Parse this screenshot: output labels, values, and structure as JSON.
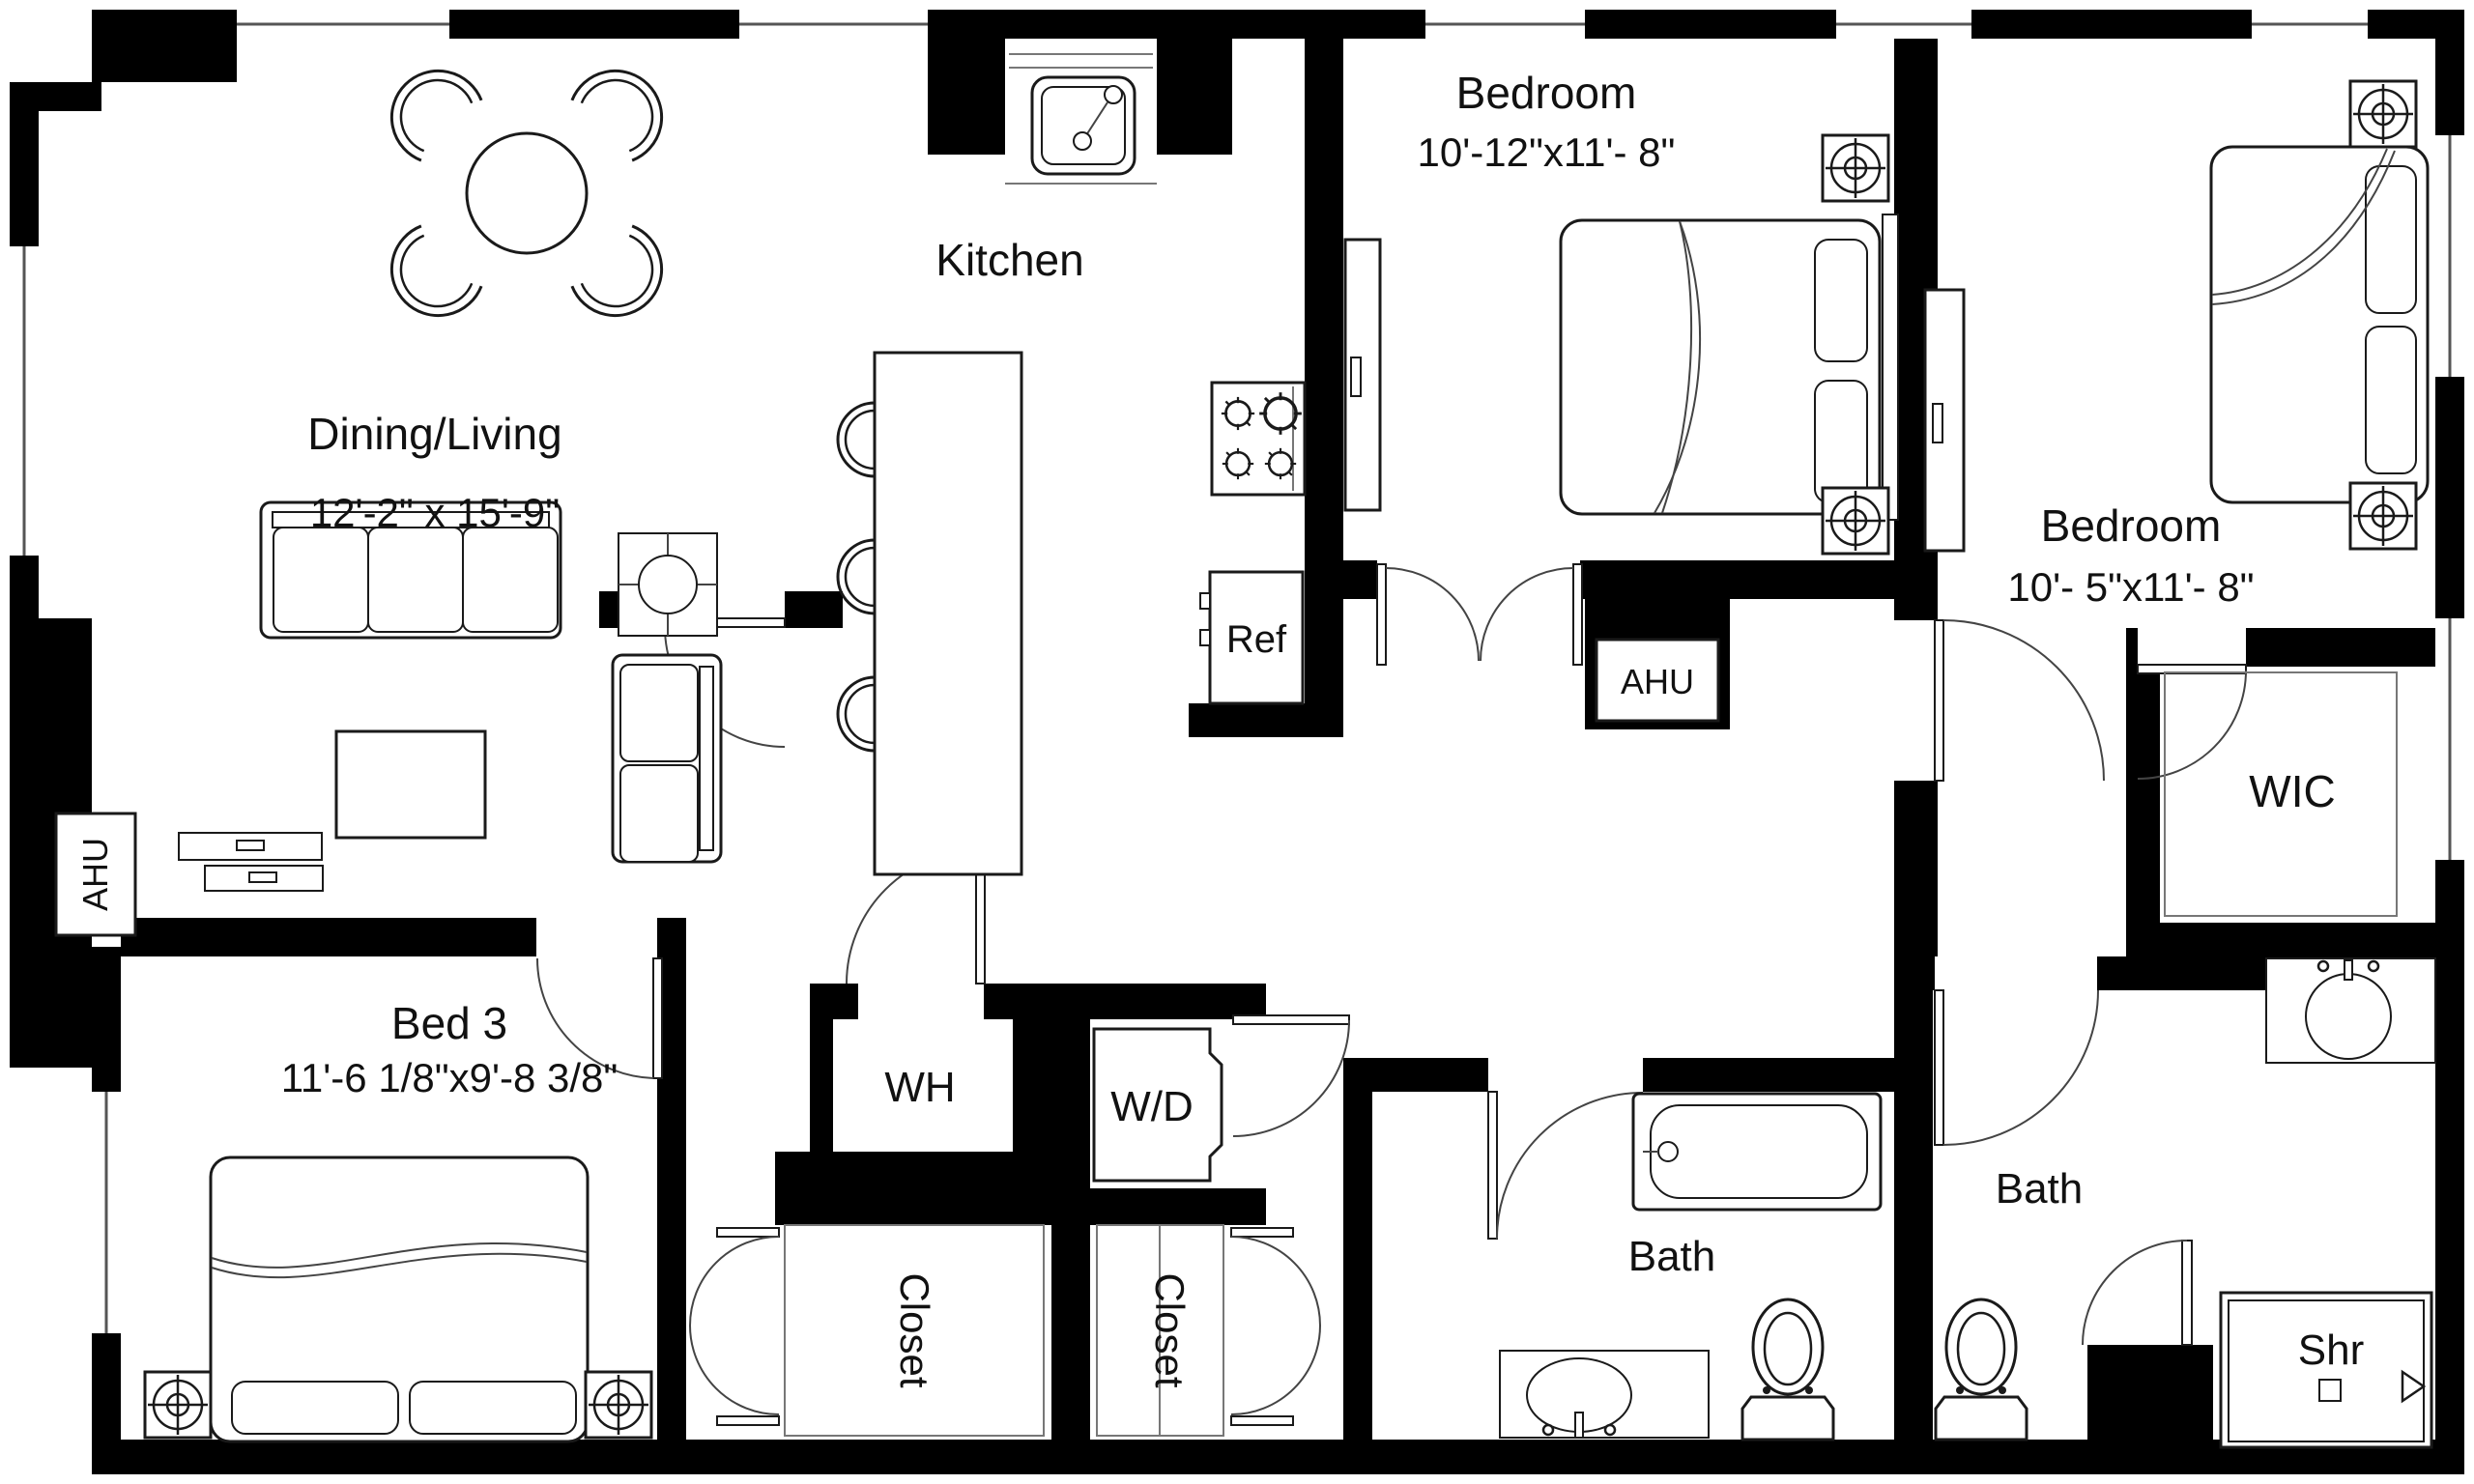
{
  "floorplan": {
    "rooms": {
      "dining_living": {
        "label": "Dining/Living",
        "dimensions": "12'-2\" x 15'-9\""
      },
      "kitchen": {
        "label": "Kitchen"
      },
      "bedroom_top": {
        "label": "Bedroom",
        "dimensions": "10'-12\"x11'- 8\""
      },
      "bedroom_right": {
        "label": "Bedroom",
        "dimensions": "10'- 5\"x11'- 8\""
      },
      "bed3": {
        "label": "Bed 3",
        "dimensions": "11'-6 1/8\"x9'-8 3/8\""
      },
      "wic": {
        "label": "WIC"
      },
      "bath_left": {
        "label": "Bath"
      },
      "bath_right": {
        "label": "Bath"
      },
      "closet_left": {
        "label": "Closet"
      },
      "closet_right": {
        "label": "Closet"
      },
      "shower": {
        "label": "Shr"
      },
      "water_heater": {
        "label": "WH"
      },
      "washer_dryer": {
        "label": "W/D"
      },
      "refrigerator": {
        "label": "Ref"
      },
      "ahu_left": {
        "label": "AHU"
      },
      "ahu_hall": {
        "label": "AHU"
      }
    },
    "colors": {
      "walls": "#000000",
      "background": "#ffffff",
      "furniture_stroke": "#1a1a1a"
    }
  }
}
